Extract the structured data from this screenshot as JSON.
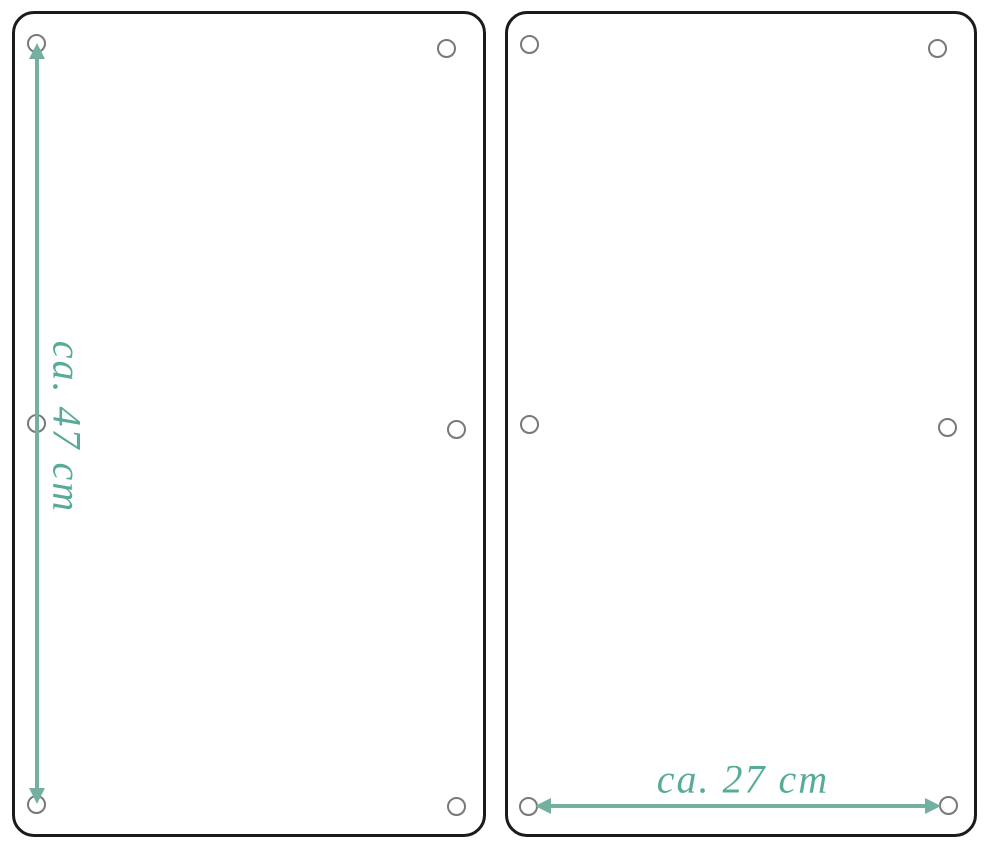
{
  "diagram": {
    "description_labels": {
      "left_panel_dimension": "ca. 47 cm",
      "right_panel_dimension": "ca. 27 cm"
    }
  },
  "panels": {
    "left": {
      "dimension_label": "ca. 47 cm",
      "dimension_axis": "vertical",
      "hole_count": 6
    },
    "right": {
      "dimension_label": "ca. 27 cm",
      "dimension_axis": "horizontal",
      "hole_count": 6
    }
  },
  "icons": {
    "mounting_hole": "circle-outline",
    "dimension_arrow": "double-headed-arrow"
  },
  "colors": {
    "background": "#ffffff",
    "panel_border": "#1b1b1b",
    "hole_outline": "#787878",
    "dimension_line": "#74b0a2",
    "dimension_text": "#58ab99"
  }
}
